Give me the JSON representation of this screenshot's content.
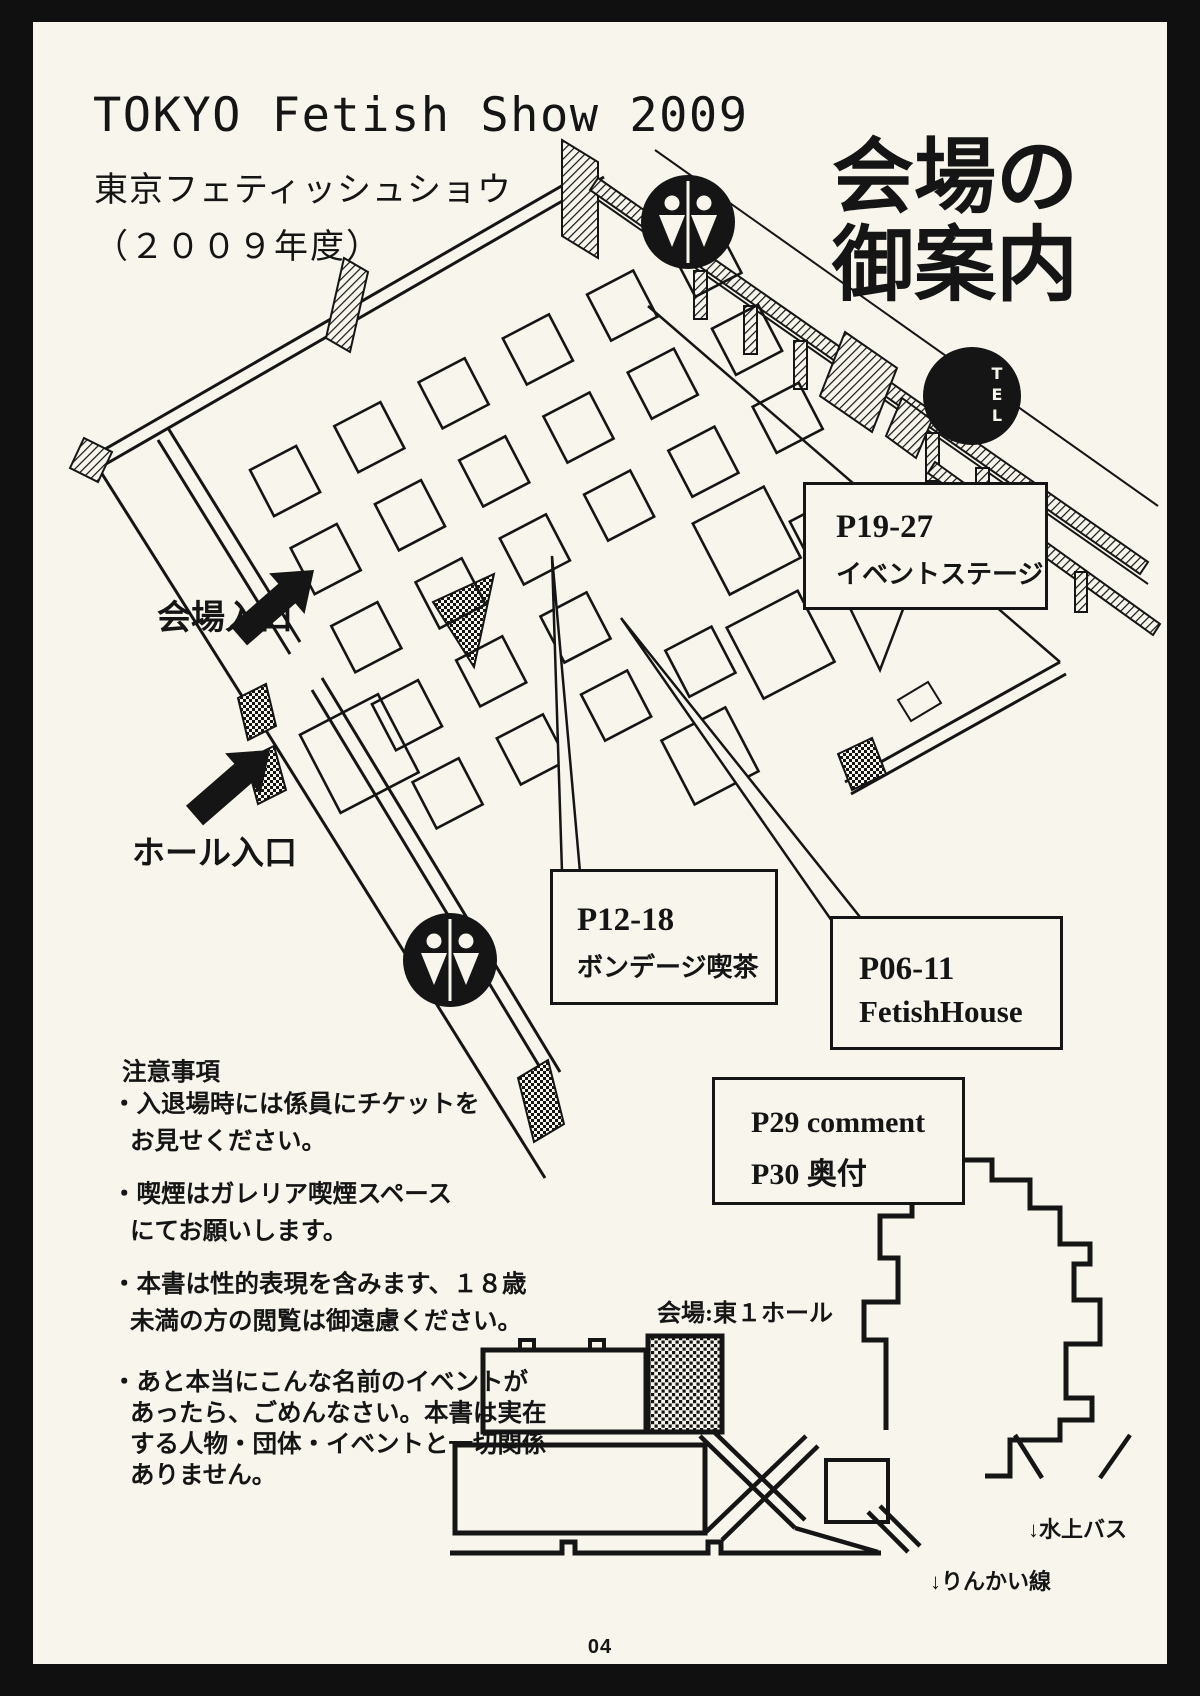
{
  "colors": {
    "paper": "#f7f5ec",
    "ink": "#151515"
  },
  "header": {
    "title_en": "TOKYO Fetish Show 2009",
    "title_ja": "東京フェティッシュショウ",
    "title_year": "（２００９年度）",
    "guide_heading_line1": "会場の",
    "guide_heading_line2": "御案内"
  },
  "map": {
    "venue_entrance_label": "会場入口",
    "hall_entrance_label": "ホール入口",
    "tel_icon_label": "TEL",
    "callouts": {
      "stage": {
        "pages": "P19-27",
        "name": "イベントステージ"
      },
      "bondage_cafe": {
        "pages": "P12-18",
        "name": "ボンデージ喫茶"
      },
      "fetish_house": {
        "pages": "P06-11",
        "name": "FetishHouse"
      },
      "comment": {
        "line1": "P29 comment",
        "line2": "P30 奥付"
      }
    }
  },
  "notes": {
    "heading": "注意事項",
    "lines": [
      "・入退場時には係員にチケットを",
      "お見せください。",
      "・喫煙はガレリア喫煙スペース",
      "にてお願いします。",
      "・本書は性的表現を含みます、１８歳",
      "未満の方の閲覧は御遠慮ください。",
      "・あと本当にこんな名前のイベントが",
      "あったら、ごめんなさい。本書は実在",
      "する人物・団体・イベントと一切関係",
      "ありません。"
    ]
  },
  "minimap": {
    "venue_label": "会場:東１ホール",
    "water_bus_label": "↓水上バス",
    "rinkai_line_label": "↓りんかい線"
  },
  "footer": {
    "page_number": "04"
  }
}
